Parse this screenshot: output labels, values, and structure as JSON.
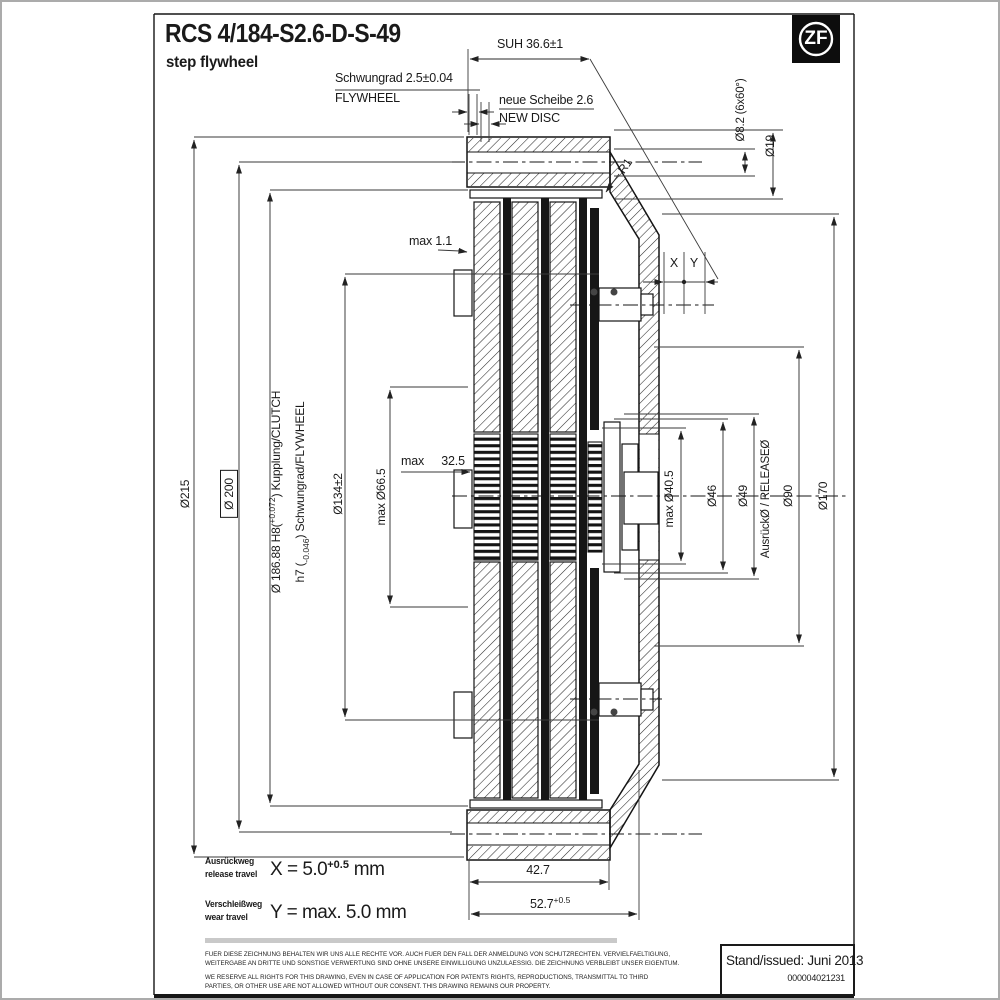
{
  "header": {
    "title": "RCS 4/184-S2.6-D-S-49",
    "subtitle": "step flywheel",
    "logo_text": "ZF"
  },
  "top_dims": {
    "suh": "SUH 36.6±1",
    "schwungrad_de": "Schwungrad 2.5±0.04",
    "schwungrad_en": "FLYWHEEL",
    "neue_scheibe_de": "neue Scheibe 2.6",
    "neue_scheibe_en": "NEW DISC",
    "radius": "R1",
    "bolt_circle": "Ø8.2 (6x60°)",
    "pilot": "Ø19"
  },
  "left_dims": {
    "d215": "Ø215",
    "d200": "Ø 200",
    "d18688_prefix": "Ø 186.88 H8(",
    "d18688_tol": "+0.072",
    "d18688_suffix": ") Kupplung/CLUTCH",
    "h7_prefix": "h7 (",
    "h7_tol": "-0.046",
    "h7_suffix": ") Schwungrad/FLYWHEEL",
    "d134": "Ø134±2",
    "d665": "max Ø66.5"
  },
  "mid_dims": {
    "max_wear_plate": "max 1.1",
    "max_hub": "max 32.5",
    "x_label": "X",
    "y_label": "Y"
  },
  "right_dims": {
    "d405": "max Ø40.5",
    "d46": "Ø46",
    "d49": "Ø49",
    "release": "AusrückØ / RELEASEØ",
    "d90": "Ø90",
    "d170": "Ø170"
  },
  "bottom_dims": {
    "w427": "42.7",
    "w527": "52.7",
    "w527_tol": "+0.5"
  },
  "travel": {
    "release_de": "Ausrückweg",
    "release_en": "release travel",
    "release_formula": "X = 5.0",
    "release_tol": "+0.5",
    "release_unit": "mm",
    "wear_de": "Verschleißweg",
    "wear_en": "wear travel",
    "wear_formula": "Y = max. 5.0 mm"
  },
  "footer": {
    "legal_de_1": "FUER DIESE ZEICHNUNG BEHALTEN WIR UNS ALLE RECHTE VOR. AUCH FUER DEN FALL DER ANMELDUNG VON SCHUTZRECHTEN. VERVIELFAELTIGUNG,",
    "legal_de_2": "WEITERGABE AN DRITTE UND SONSTIGE VERWERTUNG SIND OHNE UNSERE EINWILLIGUNG UNZULAESSIG. DIE ZEICHNUNG VERBLEIBT UNSER EIGENTUM.",
    "legal_en_1": "WE RESERVE ALL RIGHTS FOR THIS DRAWING, EVEN IN CASE OF APPLICATION FOR PATENTS RIGHTS, REPRODUCTIONS, TRANSMITTAL TO THIRD",
    "legal_en_2": "PARTIES, OR OTHER USE ARE NOT ALLOWED WITHOUT OUR CONSENT. THIS DRAWING REMAINS OUR PROPERTY.",
    "issued_label": "Stand/issued:",
    "issued_value": "Juni 2013",
    "doc_number": "000004021231"
  }
}
